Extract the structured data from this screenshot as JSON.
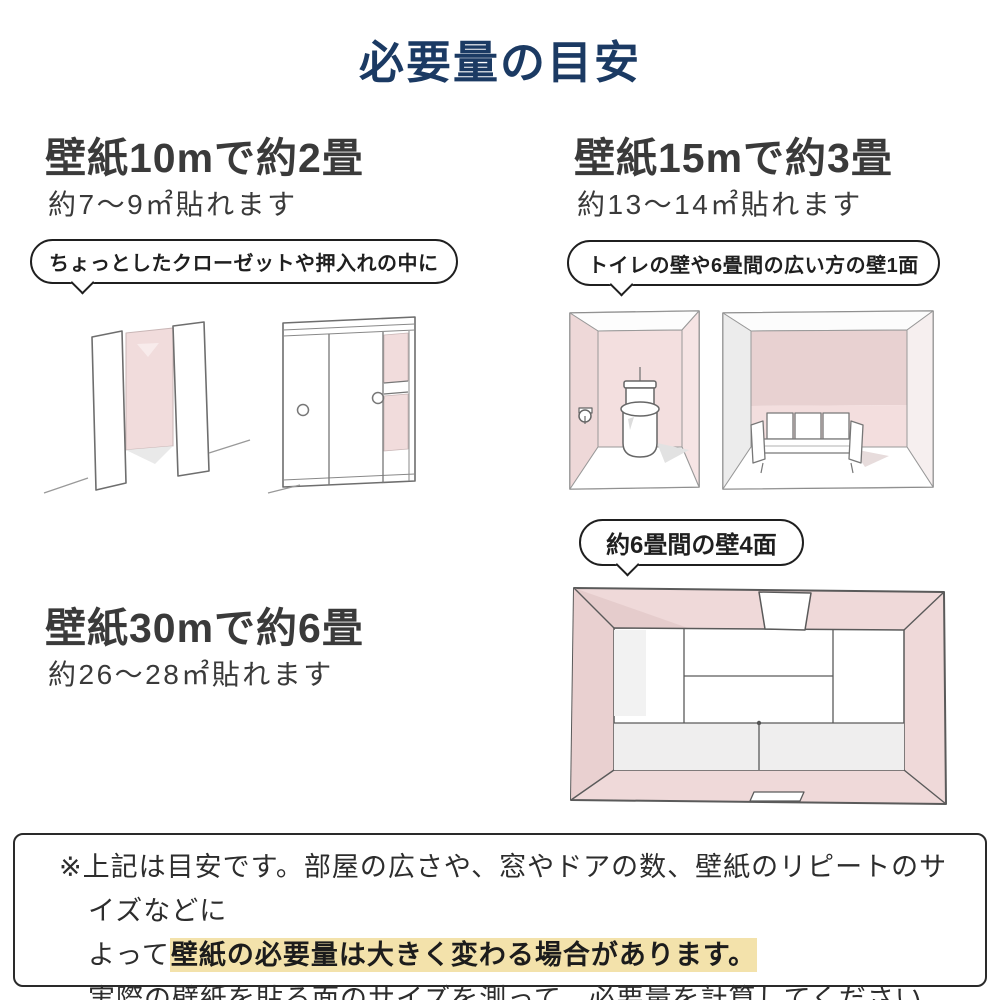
{
  "title": "必要量の目安",
  "sections": {
    "ten": {
      "heading": "壁紙10mで約2畳",
      "subtext": "約7〜9㎡貼れます",
      "bubble": "ちょっとしたクローゼットや押入れの中に"
    },
    "fifteen": {
      "heading": "壁紙15mで約3畳",
      "subtext": "約13〜14㎡貼れます",
      "bubble": "トイレの壁や6畳間の広い方の壁1面"
    },
    "thirty": {
      "heading": "壁紙30mで約6畳",
      "subtext": "約26〜28㎡貼れます",
      "bubble": "約6畳間の壁4面"
    }
  },
  "note": {
    "line1": "※上記は目安です。部屋の広さや、窓やドアの数、壁紙のリピートのサイズなどに",
    "line2_prefix": "よって",
    "line2_highlight": "壁紙の必要量は大きく変わる場合があります。",
    "line3": "実際の壁紙を貼る面のサイズを測って、必要量を計算してください。"
  },
  "colors": {
    "title_navy": "#1b3a63",
    "text_dark": "#3a3a3a",
    "wall_pink": "#f1dcdc",
    "wall_pink_dark": "#e8d1d1",
    "highlight_tan": "#f3e2ab",
    "bubble_border": "#1f1f1f"
  }
}
